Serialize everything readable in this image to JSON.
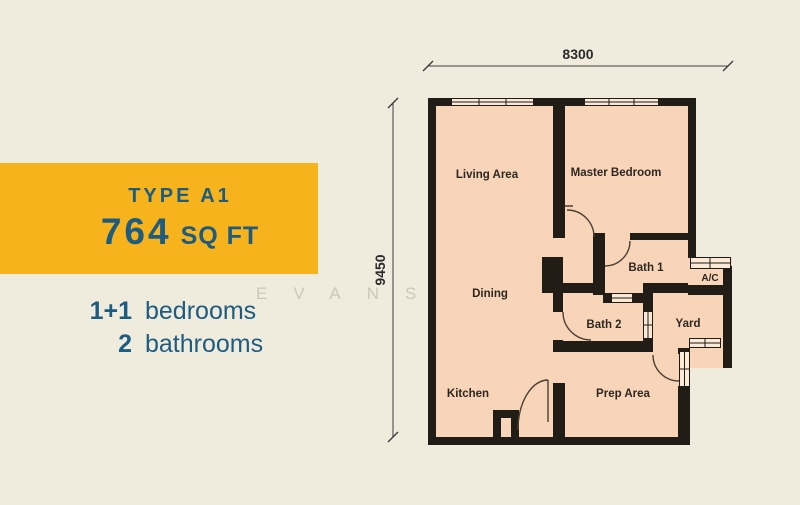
{
  "panel": {
    "type_label": "TYPE A1",
    "size_value": "764",
    "size_unit": "SQ FT",
    "specs": [
      {
        "num": "1+1",
        "label": "bedrooms"
      },
      {
        "num": "2",
        "label": "bathrooms"
      }
    ]
  },
  "watermark": {
    "text": "EVANS"
  },
  "floorplan": {
    "dims": {
      "width": "8300",
      "height": "9450"
    },
    "rooms": {
      "living": "Living Area",
      "master": "Master Bedroom",
      "dining": "Dining",
      "kitchen": "Kitchen",
      "prep": "Prep Area",
      "bath1": "Bath 1",
      "bath2": "Bath 2",
      "yard": "Yard",
      "ac": "A/C"
    }
  },
  "colors": {
    "background": "#efecde",
    "banner_yellow": "#f6b31c",
    "text_blue": "#1d5c80",
    "room_fill": "#f8d5b8",
    "wall": "#221c16"
  }
}
